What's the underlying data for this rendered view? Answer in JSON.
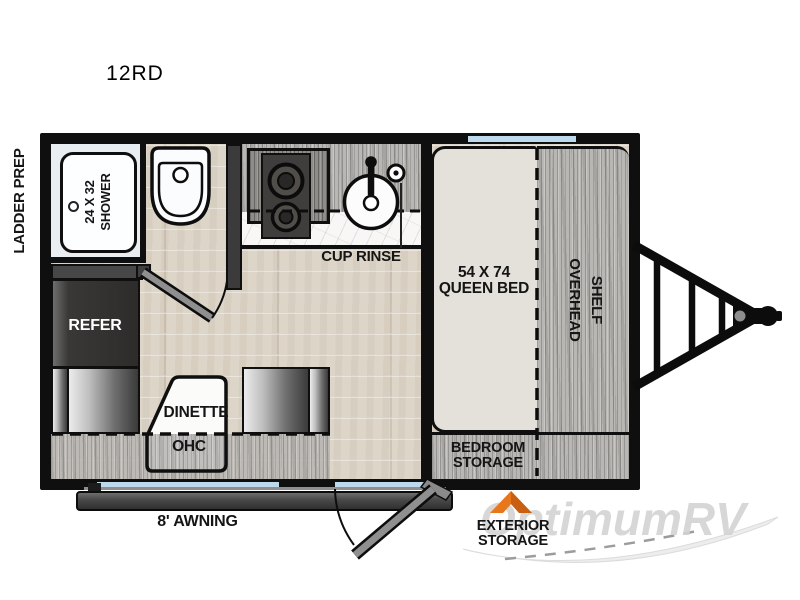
{
  "title": "12RD",
  "colors": {
    "wall": "#0f0f0f",
    "floor_wood": "#ddd5c8",
    "cabinet_gray": "#b9b7b4",
    "window_blue": "#bdd9ec",
    "accent_orange": "#e8761b",
    "bed_fill": "#e4e1da",
    "counter_white": "#f8f7f5"
  },
  "exterior": {
    "ladder_prep": "LADDER PREP",
    "awning": "8' AWNING",
    "storage_arrow_line1": "EXTERIOR",
    "storage_arrow_line2": "STORAGE",
    "watermark": "OptimumRV"
  },
  "bathroom": {
    "shower_size": "24 X 32",
    "shower": "SHOWER"
  },
  "kitchen": {
    "cup_rinse": "CUP RINSE"
  },
  "bedroom": {
    "bed_size": "54 X 74",
    "bed": "QUEEN BED",
    "shelf_word1": "OVERHEAD",
    "shelf_word2": "SHELF",
    "storage_line1": "BEDROOM",
    "storage_line2": "STORAGE"
  },
  "living": {
    "refer": "REFER",
    "dinette": "DINETTE",
    "ohc": "OHC"
  }
}
